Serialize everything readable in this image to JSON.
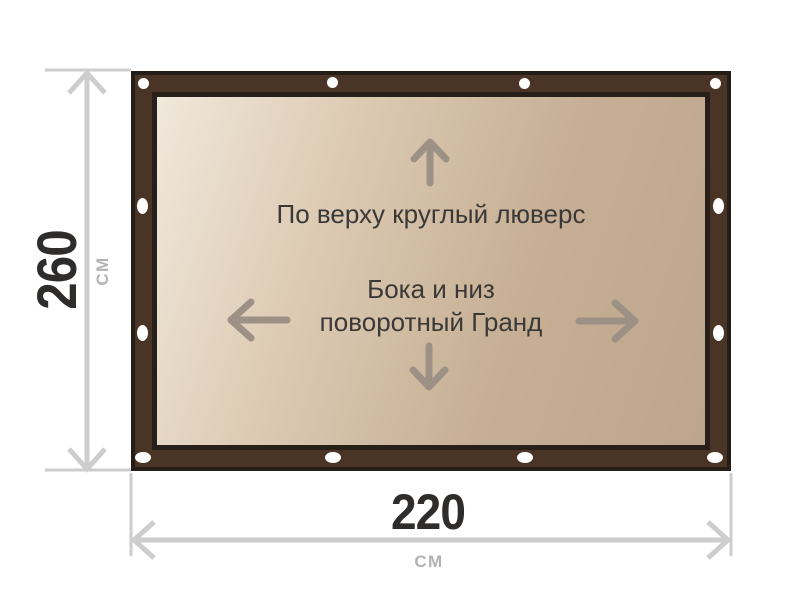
{
  "diagram": {
    "banner": {
      "top_note": "По верху круглый люверс",
      "side_note_line1": "Бока и низ",
      "side_note_line2": "поворотный Гранд"
    },
    "dimensions": {
      "height_value": "260",
      "height_unit": "СМ",
      "width_value": "220",
      "width_unit": "СМ"
    },
    "colors": {
      "frame_brown": "#4a3426",
      "frame_outline": "#251e18",
      "panel_light": "#f0e8dc",
      "panel_dark": "#bda68b",
      "grommet_white": "#ffffff",
      "inner_arrow": "#9c9184",
      "dimension_line": "#cdcdcd",
      "value_text": "#2e2d2c",
      "unit_text": "#b2b2b2",
      "note_text": "#3b3937"
    }
  }
}
